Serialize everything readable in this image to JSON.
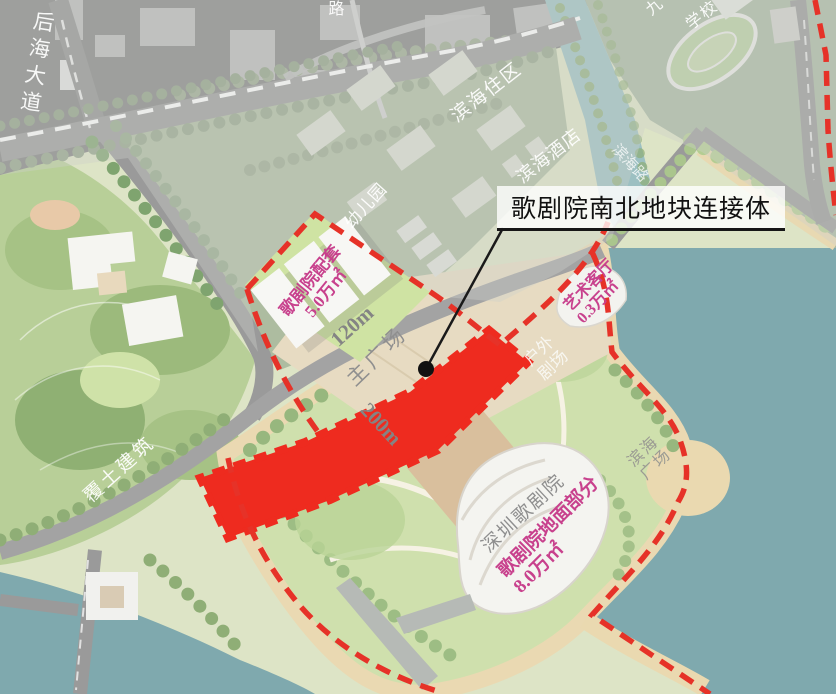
{
  "callout": {
    "text": "歌剧院南北地块连接体"
  },
  "labels": {
    "houhai_avenue": "后海大道",
    "top_road": "路",
    "binhai_residential": "滨海住区",
    "kindergarten": "幼儿园",
    "binhai_hotel": "滨海酒店",
    "nine": "九",
    "school": "学校",
    "binhai_road": "滨海路",
    "peitao": {
      "lines": [
        "歌剧院配套",
        "5.0万㎡"
      ]
    },
    "dim_120": "120m",
    "main_plaza": "主广场",
    "dim_200": "200m",
    "outdoor_theater": {
      "lines": [
        "户外",
        "剧场"
      ]
    },
    "art_hall": {
      "lines": [
        "艺术客厅",
        "0.3万㎡"
      ]
    },
    "binhai_plaza": {
      "lines": [
        "滨海",
        "广场"
      ]
    },
    "sz_opera": "深圳歌剧院",
    "opera_ground": {
      "lines": [
        "歌剧院地面部分",
        "8.0万㎡"
      ]
    },
    "futu": "覆土建筑"
  },
  "colors": {
    "boundary_red": "#e63228",
    "connector_red": "#ee2b1f",
    "pink_text": "#c8418d",
    "gray_text": "#8f8f8f",
    "water": "#7fa9ae",
    "park_green": "#b8cf98",
    "sand": "#ead9b0",
    "plaza_tan": "#e7dbc2",
    "road_gray": "#9a9a9a"
  }
}
